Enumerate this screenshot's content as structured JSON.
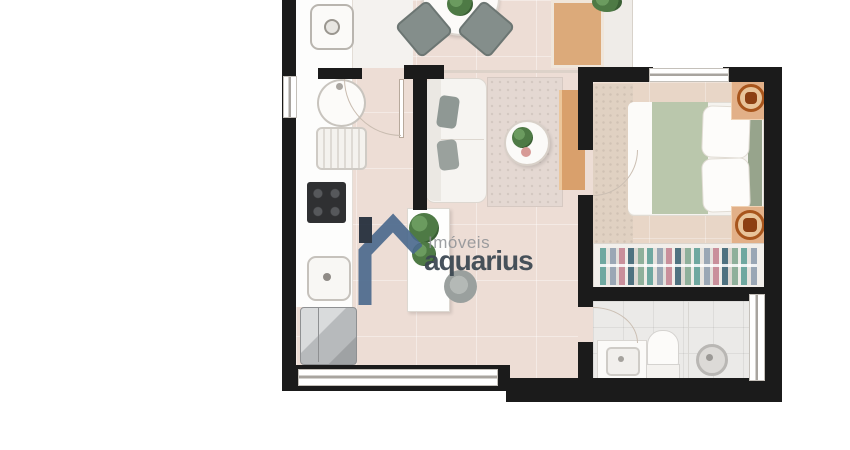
{
  "watermark": {
    "brand_line1": "Imóveis",
    "brand_line2": "aquarius",
    "house_icon_color": "#49688c",
    "chimney_color": "#1c2836",
    "brand_line1_color": "#8d9094",
    "brand_line2_color": "#3c4852"
  },
  "palette": {
    "background": "#ffffff",
    "wall": "#1b1b1b",
    "floor_living_kitchen": "#edddd5",
    "floor_service": "#f4f2ef",
    "floor_bedroom": "#e8d6c7",
    "floor_bathroom": "#ebeae8",
    "counter_white": "#fdfdfc",
    "wood_tv_console": "#d9a06c",
    "bed_blanket_green": "#bac7ac",
    "dining_chair_gray": "#848e8b",
    "cooktop_black": "#2f3032",
    "fridge_stainless": "#c8cacb",
    "lamp_accent_orange": "#b55f1e",
    "plant_green": "#4e7a45",
    "window_line_gray": "#a8a49f"
  },
  "elements": {
    "areas": [
      "service-area",
      "kitchen",
      "dining-area",
      "living-room",
      "entrance-hall",
      "bedroom",
      "closet",
      "bathroom"
    ],
    "furniture_icons": [
      "washing-machine-icon",
      "laundry-sink-icon",
      "dish-rack-icon",
      "cooktop-icon",
      "kitchen-sink-icon",
      "fridge-icon",
      "island-counter-icon",
      "stool-icon",
      "dining-table-icon",
      "dining-chair-icon",
      "plant-icon",
      "sofa-icon",
      "rug-icon",
      "coffee-table-icon",
      "tv-panel-icon",
      "tv-console-icon",
      "bed-icon",
      "pillow-icon",
      "nightstand-lamp-icon",
      "wardrobe-clothes-icon",
      "bathroom-vanity-icon",
      "toilet-icon",
      "shower-head-icon",
      "window-icon",
      "door-swing-icon"
    ]
  }
}
